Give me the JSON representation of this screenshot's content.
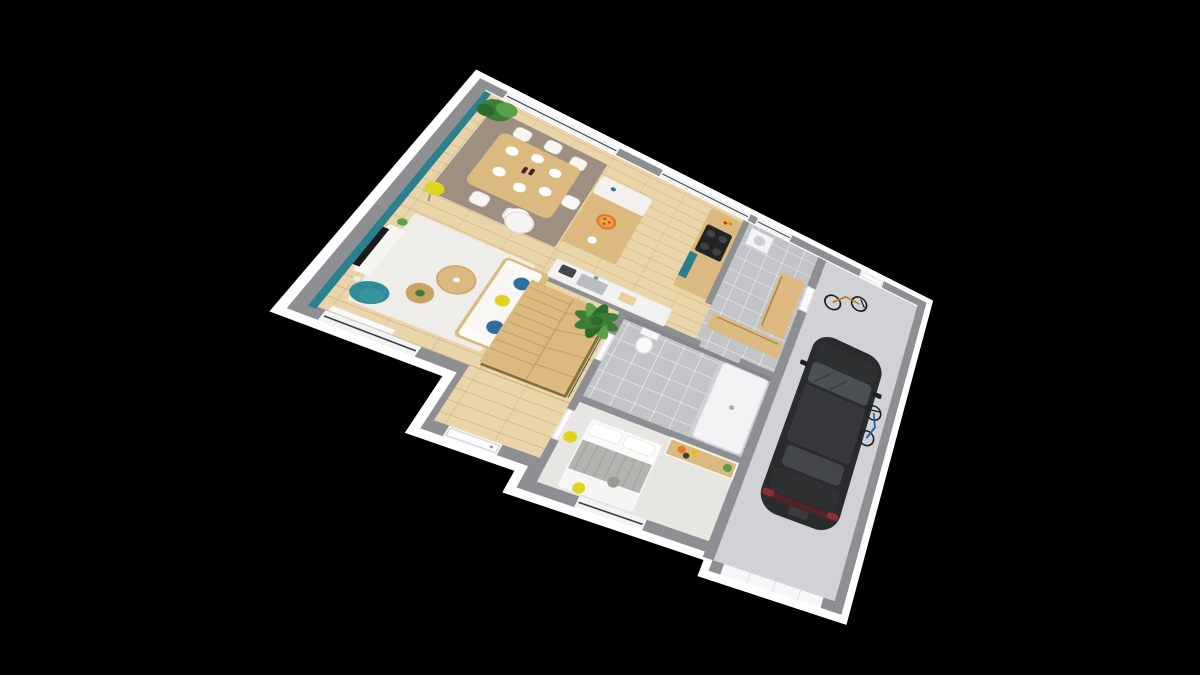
{
  "canvas": {
    "width": 1200,
    "height": 675,
    "background": "#000000"
  },
  "projection": {
    "plan_width": 600,
    "plan_height": 470,
    "src_points": [
      [
        0,
        0
      ],
      [
        600,
        0
      ],
      [
        0,
        342
      ],
      [
        600,
        450
      ]
    ],
    "dst_points": [
      [
        483,
        84
      ],
      [
        922,
        304
      ],
      [
        298,
        306
      ],
      [
        838,
        608
      ]
    ]
  },
  "palette": {
    "background": "#000000",
    "slab_white": "#ffffff",
    "wall_top": "#8e8f93",
    "window_white": "#f2f3f4",
    "glass_line": "#2a2a2a",
    "door_white": "#fbfbfb",
    "floor_wood": "#e9d5a9",
    "floor_tile": "#c3c4c8",
    "floor_carpet": "#e8e6e2",
    "floor_garage": "#d1d2d6",
    "teal_wall": "#2b808e",
    "teal_chair": "#2e8b99",
    "teal_cabinet": "#2b7f8d",
    "rug_taupe": "#9d8f82",
    "rug_white": "#efede9",
    "furniture_wood": "#dcb97e",
    "furniture_wood_dark": "#c9a264",
    "white_furniture": "#f6f5f2",
    "plant_green": "#3e7d35",
    "plant_green_light": "#58a04a",
    "plant_green_dark": "#2d6b28",
    "accent_yellow": "#ddd51f",
    "accent_blue": "#2e6f9e",
    "accent_orange": "#e07b2a",
    "shower_wall": "#85878a",
    "steel": "#b9bdc2",
    "tv_black": "#1b1b1d",
    "car_body": "#292b2d",
    "car_hood": "#2e3032",
    "car_roof": "#36383b",
    "car_windshield": "#4b5054",
    "car_rear_glass": "#43464a",
    "taillight_red": "#8c2f38",
    "bike_dark": "#1c1c1c",
    "bike_orange": "#c07820",
    "bike_blue": "#2060b0",
    "blanket_gray": "#b5b3b0",
    "cushion_gray": "#9b9996"
  },
  "scene": {
    "type": "3d-floor-plan-render",
    "view": "rotated top-down axonometric, single storey, black background",
    "rooms": [
      {
        "name": "living-room",
        "floor": "wood",
        "accent": "teal west wall"
      },
      {
        "name": "dining-area",
        "floor": "wood",
        "rug": "taupe"
      },
      {
        "name": "open-kitchen",
        "floor": "wood"
      },
      {
        "name": "pantry-hallway",
        "floor": "gray tile"
      },
      {
        "name": "bathroom",
        "floor": "gray tile"
      },
      {
        "name": "bedroom",
        "floor": "light carpet"
      },
      {
        "name": "entry-hall",
        "floor": "wood"
      },
      {
        "name": "staircase",
        "material": "wood winder stairs with railing"
      },
      {
        "name": "garage",
        "floor": "concrete"
      }
    ],
    "objects": [
      "corner-plant",
      "dining-table-with-six-white-chairs",
      "plates-and-wine-bottles",
      "yellow-floor-lamp",
      "white-armchair",
      "teal-armchair",
      "tv-on-white-stand",
      "round-coffee-tables",
      "white-rug",
      "white-sofa-with-blue-and-yellow-pillows",
      "kitchen-island-with-two-stools",
      "pizza-dish",
      "sink-counter-with-toaster",
      "cooktop-counter-with-teal-cabinet",
      "fruit-bowl",
      "washing-machine",
      "wood-cabinets",
      "palm-plant",
      "wood-staircase",
      "front-door",
      "shower",
      "toilet",
      "vanity-with-flower-pots",
      "double-bed-gray-blanket",
      "yellow-sphere-lamps",
      "black-car-top-view",
      "dark-kids-bike",
      "blue-bike",
      "garage-door",
      "service-door"
    ]
  }
}
